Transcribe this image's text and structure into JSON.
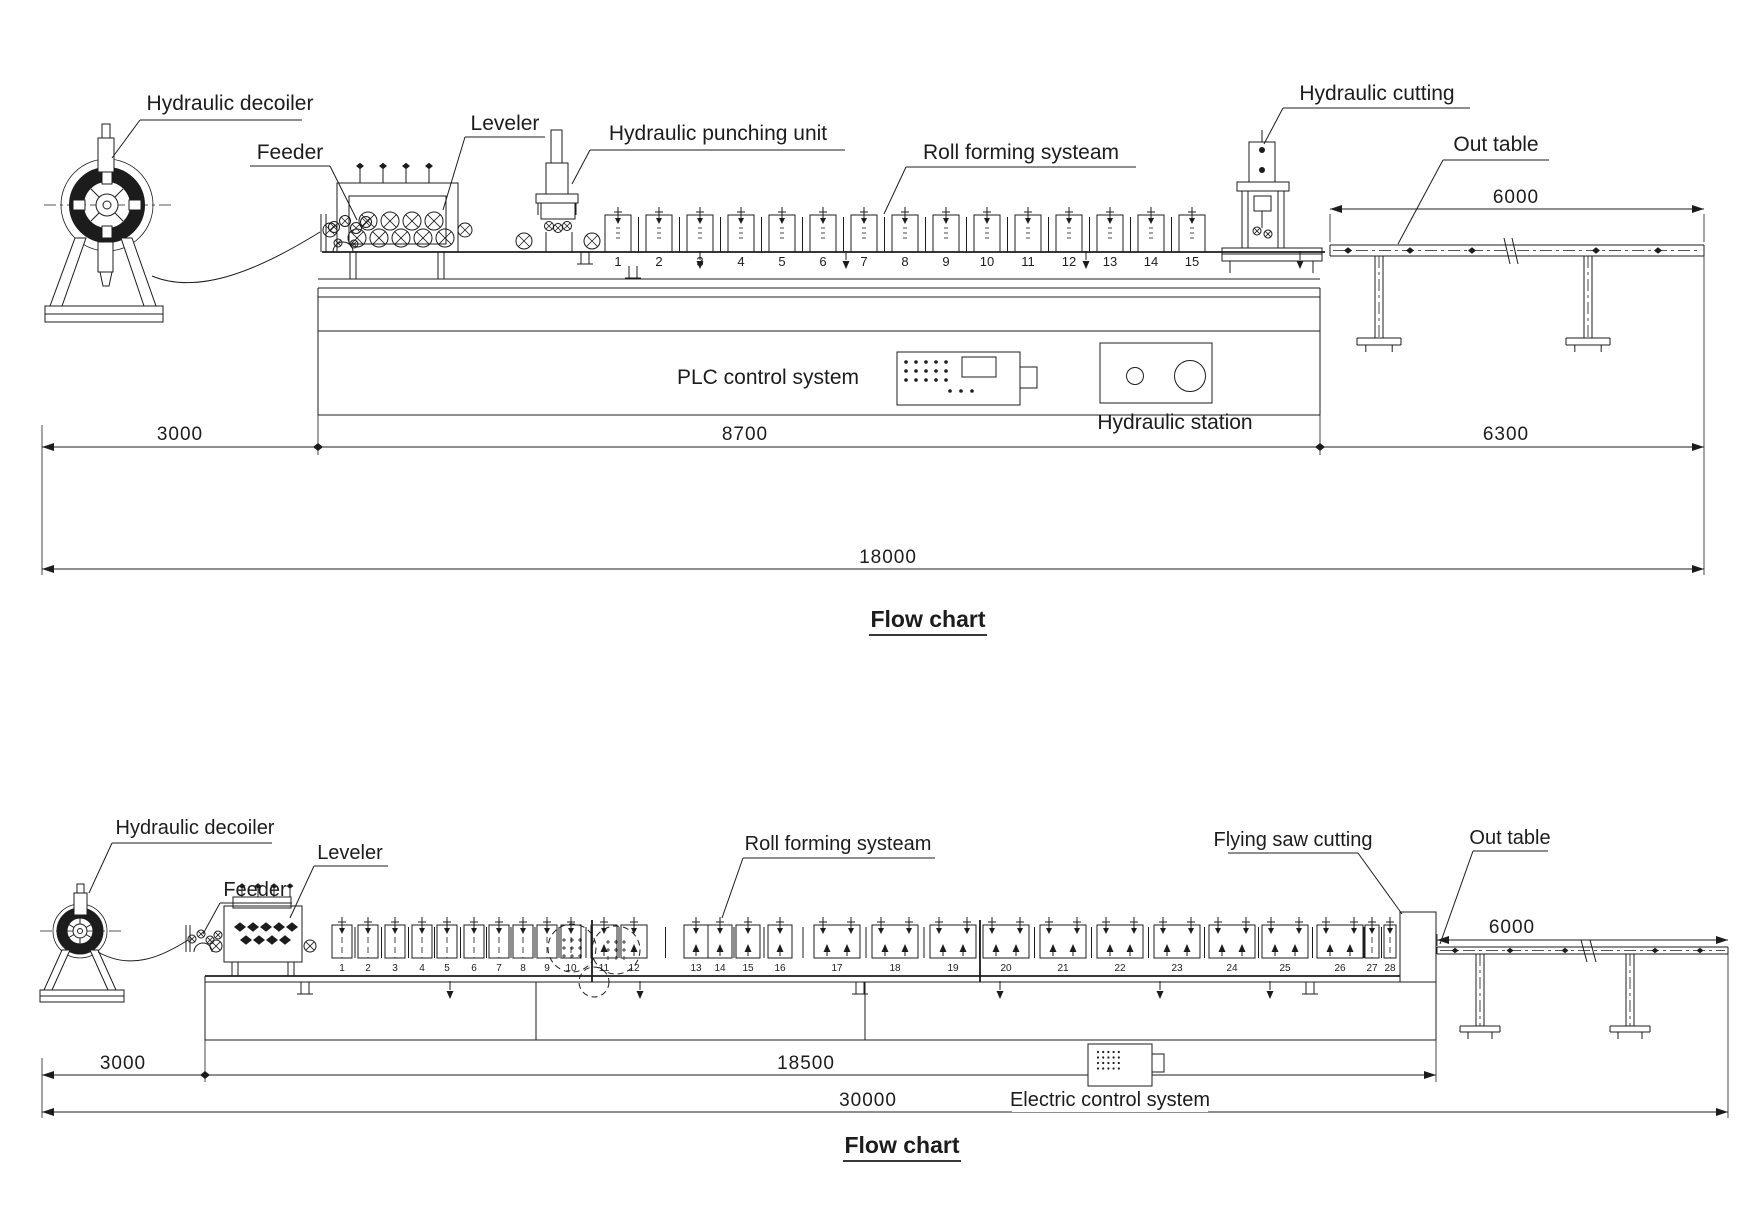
{
  "colors": {
    "line": "#1c1c1c",
    "background": "#ffffff"
  },
  "top": {
    "labels": {
      "decoiler": "Hydraulic decoiler",
      "feeder": "Feeder",
      "leveler": "Leveler",
      "punching_unit": "Hydraulic punching unit",
      "roll_forming": "Roll forming systeam",
      "cutting": "Hydraulic cutting",
      "out_table": "Out table",
      "plc": "PLC control system",
      "hydraulic_station": "Hydraulic station"
    },
    "dimensions": {
      "out_table_length": "6000",
      "decoiler_section": "3000",
      "main_section": "8700",
      "outfeed_section": "6300",
      "total_length": "18000"
    },
    "station_numbers": [
      "1",
      "2",
      "3",
      "4",
      "5",
      "6",
      "7",
      "8",
      "9",
      "10",
      "11",
      "12",
      "13",
      "14",
      "15"
    ],
    "caption": "Flow chart"
  },
  "bottom": {
    "labels": {
      "decoiler": "Hydraulic decoiler",
      "feeder": "Feeder",
      "leveler": "Leveler",
      "roll_forming": "Roll forming systeam",
      "flying_saw": "Flying saw cutting",
      "out_table": "Out table",
      "electric": "Electric control system"
    },
    "dimensions": {
      "out_table_length": "6000",
      "decoiler_section": "3000",
      "main_section": "18500",
      "total_length": "30000"
    },
    "station_numbers": [
      "1",
      "2",
      "3",
      "4",
      "5",
      "6",
      "7",
      "8",
      "9",
      "10",
      "11",
      "12",
      "13",
      "14",
      "15",
      "16",
      "17",
      "18",
      "19",
      "20",
      "21",
      "22",
      "23",
      "24",
      "25",
      "26",
      "27",
      "28"
    ],
    "caption": "Flow chart"
  }
}
